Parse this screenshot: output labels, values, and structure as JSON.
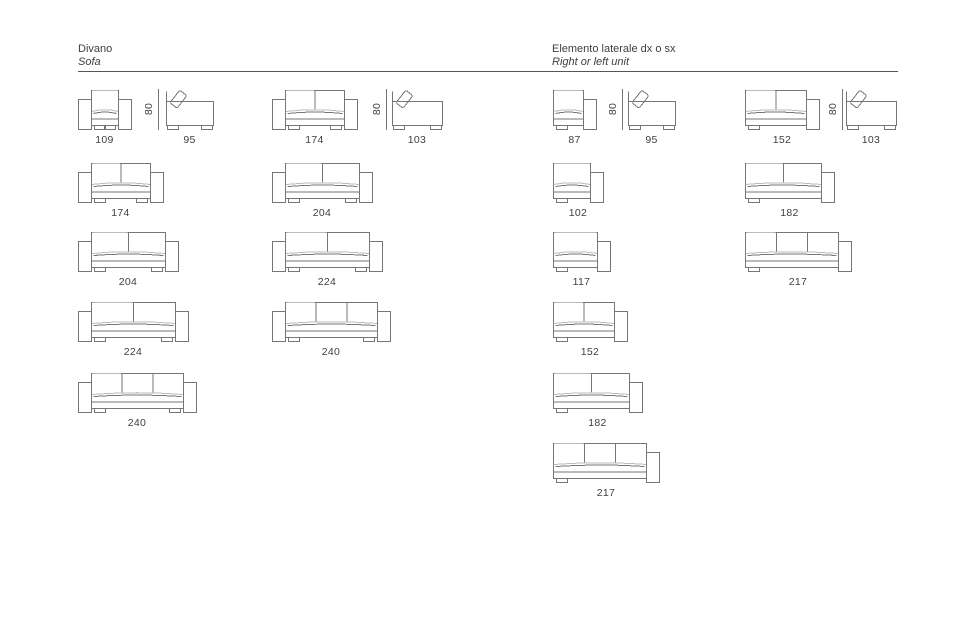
{
  "header": {
    "left": {
      "title": "Divano",
      "subtitle": "Sofa"
    },
    "right": {
      "title": "Elemento laterale dx o sx",
      "subtitle": "Right or left unit"
    }
  },
  "rule": {
    "x": 78,
    "y": 71,
    "width": 820
  },
  "dim_height_label": "80",
  "colors": {
    "line": "#767676",
    "light": "#b9bcbc",
    "text": "#404040",
    "rule": "#555555",
    "background": "#ffffff"
  },
  "layout": {
    "scale_px_per_cm": 0.49,
    "drawing_height": 40,
    "row_tops": [
      90,
      162.5,
      231.5,
      301.5,
      372.5,
      442.5
    ],
    "label_offset": 44,
    "header_x": {
      "left": 78,
      "right": 552
    }
  },
  "drawings": [
    {
      "section": "sofa",
      "row": 0,
      "x": 78,
      "view": "front",
      "arms": "both",
      "cushions": 1,
      "cm": 109,
      "label": "109"
    },
    {
      "section": "sofa",
      "row": 0,
      "x": 158,
      "view": "dim"
    },
    {
      "section": "sofa",
      "row": 0,
      "x": 166,
      "view": "side",
      "cm": 95,
      "label": "95"
    },
    {
      "section": "sofa",
      "row": 0,
      "x": 272,
      "view": "front",
      "arms": "both",
      "cushions": 2,
      "cm": 174,
      "label": "174"
    },
    {
      "section": "sofa",
      "row": 0,
      "x": 386,
      "view": "dim"
    },
    {
      "section": "sofa",
      "row": 0,
      "x": 392,
      "view": "side",
      "cm": 103,
      "label": "103"
    },
    {
      "section": "sofa",
      "row": 1,
      "x": 78,
      "view": "front",
      "arms": "both",
      "cushions": 2,
      "cm": 174,
      "label": "174"
    },
    {
      "section": "sofa",
      "row": 1,
      "x": 272,
      "view": "front",
      "arms": "both",
      "cushions": 2,
      "cm": 204,
      "label": "204"
    },
    {
      "section": "sofa",
      "row": 2,
      "x": 78,
      "view": "front",
      "arms": "both",
      "cushions": 2,
      "cm": 204,
      "label": "204"
    },
    {
      "section": "sofa",
      "row": 2,
      "x": 272,
      "view": "front",
      "arms": "both",
      "cushions": 2,
      "cm": 224,
      "label": "224"
    },
    {
      "section": "sofa",
      "row": 3,
      "x": 78,
      "view": "front",
      "arms": "both",
      "cushions": 2,
      "cm": 224,
      "label": "224"
    },
    {
      "section": "sofa",
      "row": 3,
      "x": 272,
      "view": "front",
      "arms": "both",
      "cushions": 3,
      "cm": 240,
      "label": "240"
    },
    {
      "section": "sofa",
      "row": 4,
      "x": 78,
      "view": "front",
      "arms": "both",
      "cushions": 3,
      "cm": 240,
      "label": "240"
    },
    {
      "section": "lateral",
      "row": 0,
      "x": 553,
      "view": "front",
      "arms": "right",
      "cushions": 1,
      "cm": 87,
      "label": "87"
    },
    {
      "section": "lateral",
      "row": 0,
      "x": 622,
      "view": "dim"
    },
    {
      "section": "lateral",
      "row": 0,
      "x": 628,
      "view": "side",
      "cm": 95,
      "label": "95"
    },
    {
      "section": "lateral",
      "row": 0,
      "x": 745,
      "view": "front",
      "arms": "right",
      "cushions": 2,
      "cm": 152,
      "label": "152"
    },
    {
      "section": "lateral",
      "row": 0,
      "x": 842,
      "view": "dim"
    },
    {
      "section": "lateral",
      "row": 0,
      "x": 846,
      "view": "side",
      "cm": 103,
      "label": "103"
    },
    {
      "section": "lateral",
      "row": 1,
      "x": 553,
      "view": "front",
      "arms": "right",
      "cushions": 1,
      "cm": 102,
      "label": "102"
    },
    {
      "section": "lateral",
      "row": 1,
      "x": 745,
      "view": "front",
      "arms": "right",
      "cushions": 2,
      "cm": 182,
      "label": "182"
    },
    {
      "section": "lateral",
      "row": 2,
      "x": 553,
      "view": "front",
      "arms": "right",
      "cushions": 1,
      "cm": 117,
      "label": "117"
    },
    {
      "section": "lateral",
      "row": 2,
      "x": 745,
      "view": "front",
      "arms": "right",
      "cushions": 3,
      "cm": 217,
      "label": "217"
    },
    {
      "section": "lateral",
      "row": 3,
      "x": 553,
      "view": "front",
      "arms": "right",
      "cushions": 2,
      "cm": 152,
      "label": "152"
    },
    {
      "section": "lateral",
      "row": 4,
      "x": 553,
      "view": "front",
      "arms": "right",
      "cushions": 2,
      "cm": 182,
      "label": "182"
    },
    {
      "section": "lateral",
      "row": 5,
      "x": 553,
      "view": "front",
      "arms": "right",
      "cushions": 3,
      "cm": 217,
      "label": "217"
    }
  ]
}
